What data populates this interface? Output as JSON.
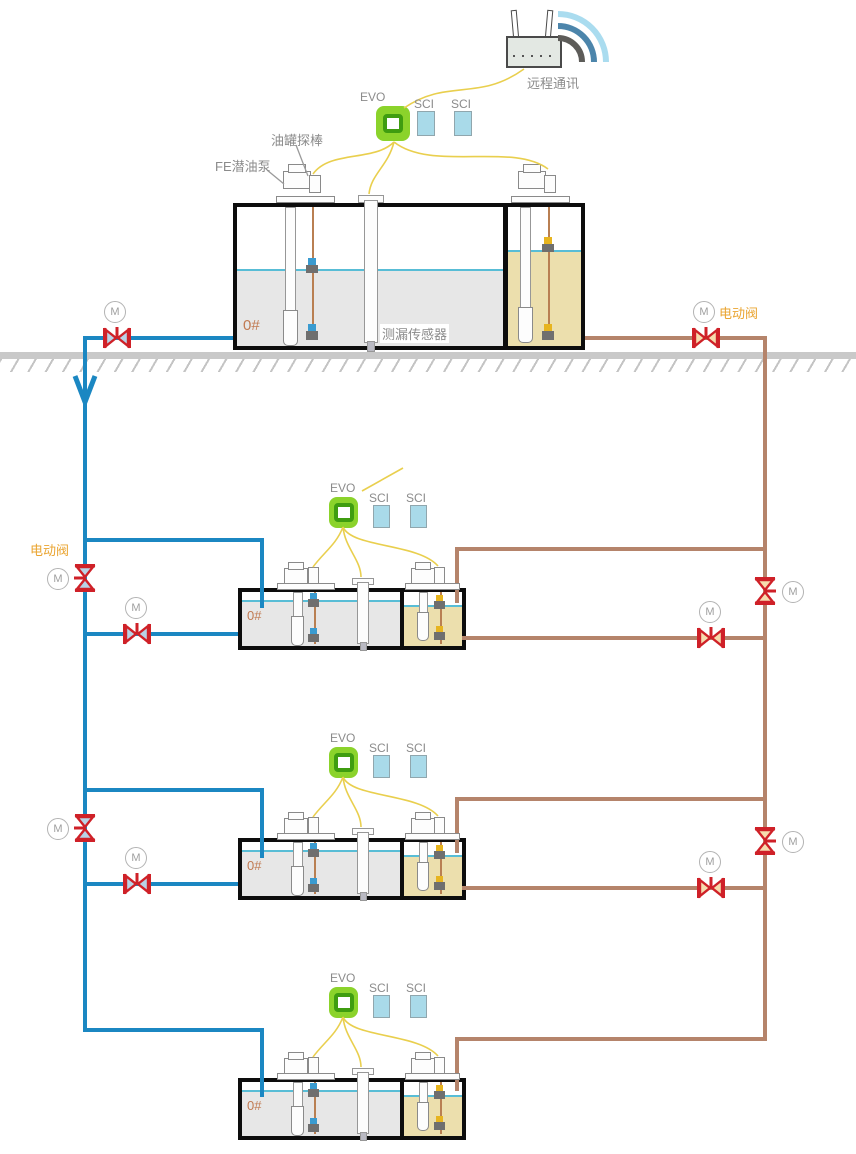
{
  "labels": {
    "remote_comm": "远程通讯",
    "evo": "EVO",
    "sci": "SCI",
    "tank_probe": "油罐探棒",
    "fe_pump": "FE潜油泵",
    "leak_sensor": "测漏传感器",
    "electric_valve": "电动阀",
    "motor": "M"
  },
  "stations": [
    {
      "name": "above-ground-tank-station",
      "grade": "0#"
    },
    {
      "name": "underground-tank-station-1",
      "grade": "0#"
    },
    {
      "name": "underground-tank-station-2",
      "grade": "0#"
    },
    {
      "name": "underground-tank-station-3",
      "grade": "0#"
    }
  ],
  "colors": {
    "supply_pipe_blue": "#1b87c2",
    "return_pipe_brown": "#b5846b",
    "signal_wire_yellow": "#e9cf4e",
    "valve_red": "#cf2128",
    "valve_fill_blue": "#b9d3e6",
    "valve_fill_tan": "#f6dcae",
    "evo_green": "#8bd32b",
    "sci_blue": "#a9dae9",
    "tank_fill_gray": "#e7e7e7",
    "tank_fill_tan": "#ecdfad",
    "liquid_level_cyan": "#58bdd6",
    "label_gray": "#8b8b8b",
    "label_orange": "#eaa430",
    "grade_label": "#c17a52"
  }
}
